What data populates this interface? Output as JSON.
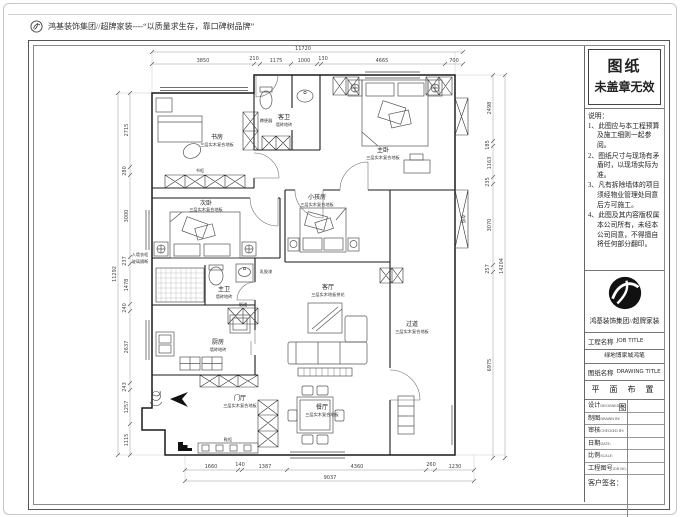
{
  "header": {
    "brand_text": "鸿基装饰集团//超牌家装----“以质量求生存，靠口碑树品牌”"
  },
  "title_block": {
    "stamp": {
      "line1": "图纸",
      "line2": "未盖章无效"
    },
    "notes_title": "说明：",
    "notes": [
      "1、此图应与本工程预算及施工细则一起参阅。",
      "2、图纸尺寸与现场有矛盾时，以现场实际为准。",
      "3、凡有拆除墙体的项目须经物业管理处同意后方可施工。",
      "4、此图及其内容版权属本公司所有，未经本公司同意，不得擅自将任何部分翻印。"
    ],
    "company": "鸿基装饰集团//超牌家装",
    "job_label": "工程名称",
    "job_label_en": "JOB TITLE",
    "project_name": "绿地博家城鸿笔",
    "drawing_label": "图纸名称",
    "drawing_label_en": "DRAWING TITLE",
    "drawing_title": "平 面 布 置 图",
    "fields": [
      {
        "label": "设计",
        "en": "DESIGNED BY:"
      },
      {
        "label": "制图",
        "en": "DRAWN BY:"
      },
      {
        "label": "审核",
        "en": "CHECKED BY:"
      },
      {
        "label": "日期",
        "en": "DATE:"
      },
      {
        "label": "比例",
        "en": "SCALE:"
      },
      {
        "label": "工程图号",
        "en": "JOB NO.:"
      }
    ],
    "signature_label": "客户签名："
  },
  "plan": {
    "dims": {
      "top_total": "11720",
      "top_segments": [
        "3850",
        "210",
        "1175",
        "1000",
        "130",
        "4665",
        "700"
      ],
      "bottom_total": "9037",
      "bottom_segments": [
        "1660",
        "140",
        "1387",
        "4360",
        "260",
        "1230"
      ],
      "left_total": "11292",
      "left_segments": [
        "2715",
        "280",
        "3000",
        "237",
        "1478",
        "240",
        "2637",
        "243",
        "1257",
        "1115"
      ],
      "right_total": "14204",
      "right_segments": [
        "2498",
        "185",
        "1163",
        "235",
        "3070",
        "257",
        "6975"
      ]
    },
    "rooms": {
      "study": {
        "name": "书房",
        "material": "三层实木复合地板"
      },
      "guest_bath": {
        "name": "客卫",
        "material": "墙砖地砖"
      },
      "master": {
        "name": "主卧",
        "material": "三层实木复合地板"
      },
      "second": {
        "name": "次卧",
        "material": "三层实木复合地板"
      },
      "kids": {
        "name": "小孩房",
        "material": "三层实木复合地板"
      },
      "master_bath": {
        "name": "主卫",
        "material": "墙砖地砖"
      },
      "kitchen": {
        "name": "厨房",
        "material": "墙砖地砖"
      },
      "living": {
        "name": "客厅",
        "material": "三层实木地板拼花"
      },
      "dining": {
        "name": "餐厅",
        "material": "三层实木复合地板"
      },
      "hallway": {
        "name": "过道",
        "material": "三层实木复合地板"
      },
      "foyer": {
        "name": "门厅",
        "material": "三层实木复合地板"
      }
    },
    "annotations": {
      "bookcase": "书柜",
      "wardrobe": "衣柜",
      "flue": "烟道",
      "shoe": "鞋柜",
      "squat": "蹲便器",
      "wall_note1": "入墙衣柜",
      "wall_note2": "玻璃隔断",
      "paint": "乳胶漆"
    }
  }
}
